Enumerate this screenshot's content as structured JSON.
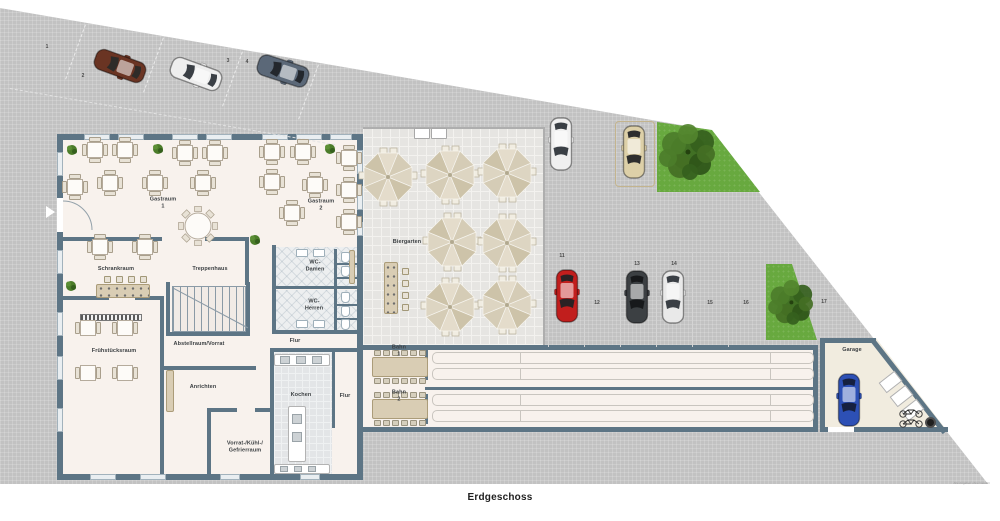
{
  "title": {
    "text": "Erdgeschoss"
  },
  "watermark": {
    "text": "Alle Angaben ohne Gewähr"
  },
  "palette": {
    "wall": "#5d7585",
    "pavement": "#c2c2c2",
    "floor": "#f8f2ed",
    "biergarten_tile": "#e6e5e2",
    "grass": "#68a93f",
    "wood": "#d9cdb4"
  },
  "rooms": [
    {
      "id": "gastraum-1",
      "label": "Gastraum 1",
      "x": 163,
      "y": 203
    },
    {
      "id": "gastraum-2",
      "label": "Gastraum 2",
      "x": 321,
      "y": 205
    },
    {
      "id": "schrankraum",
      "label": "Schrankraum",
      "x": 116,
      "y": 269
    },
    {
      "id": "treppenhaus",
      "label": "Treppenhaus",
      "x": 210,
      "y": 269
    },
    {
      "id": "wc-damen",
      "label": "WC-Damen",
      "x": 315,
      "y": 266
    },
    {
      "id": "wc-herren",
      "label": "WC-Herren",
      "x": 314,
      "y": 305
    },
    {
      "id": "flur-1",
      "label": "Flur",
      "x": 295,
      "y": 341
    },
    {
      "id": "fruehstuecksraum",
      "label": "Frühstücksraum",
      "x": 114,
      "y": 351
    },
    {
      "id": "abstellraum-vorrat",
      "label": "Abstellraum/Vorrat",
      "x": 199,
      "y": 344
    },
    {
      "id": "anrichten",
      "label": "Anrichten",
      "x": 203,
      "y": 387
    },
    {
      "id": "kochen",
      "label": "Kochen",
      "x": 301,
      "y": 395
    },
    {
      "id": "flur-2",
      "label": "Flur",
      "x": 345,
      "y": 396
    },
    {
      "id": "vorrat-kuehl-gefrierraum",
      "label": "Vorrat-/Kühl-/\nGefrierraum",
      "x": 245,
      "y": 447
    },
    {
      "id": "bahn-1",
      "label": "Bahn 1",
      "x": 399,
      "y": 351
    },
    {
      "id": "bahn-2",
      "label": "Bahn 2",
      "x": 399,
      "y": 396
    },
    {
      "id": "biergarten",
      "label": "Biergarten",
      "x": 407,
      "y": 242
    },
    {
      "id": "garage",
      "label": "Garage",
      "x": 852,
      "y": 350
    }
  ],
  "parking_numbers": [
    {
      "n": "1",
      "x": 47,
      "y": 47
    },
    {
      "n": "2",
      "x": 83,
      "y": 76
    },
    {
      "n": "3",
      "x": 228,
      "y": 61
    },
    {
      "n": "4",
      "x": 247,
      "y": 62
    },
    {
      "n": "11",
      "x": 562,
      "y": 256
    },
    {
      "n": "12",
      "x": 597,
      "y": 303
    },
    {
      "n": "13",
      "x": 637,
      "y": 264
    },
    {
      "n": "14",
      "x": 674,
      "y": 264
    },
    {
      "n": "15",
      "x": 710,
      "y": 303
    },
    {
      "n": "16",
      "x": 746,
      "y": 303
    },
    {
      "n": "17",
      "x": 824,
      "y": 302
    }
  ],
  "cars": [
    {
      "id": "car-space-2-brown",
      "color": "#6a3423",
      "glass": "#2e2b28",
      "x": 120,
      "y": 66,
      "rot": 110
    },
    {
      "id": "car-space-3-white",
      "color": "#eeeeee",
      "glass": "#3a3f45",
      "x": 196,
      "y": 74,
      "rot": 110
    },
    {
      "id": "car-space-4-gray",
      "color": "#5b6878",
      "glass": "#23272d",
      "x": 283,
      "y": 71,
      "rot": 108
    },
    {
      "id": "car-top-white",
      "color": "#f0f0f0",
      "glass": "#3a3f45",
      "x": 561,
      "y": 144,
      "rot": 0
    },
    {
      "id": "van-top-beige",
      "color": "#ddd0a8",
      "glass": "#2e2e2e",
      "x": 634,
      "y": 152,
      "rot": 0
    },
    {
      "id": "car-space-11-red",
      "color": "#c11e1d",
      "glass": "#2a2224",
      "x": 567,
      "y": 296,
      "rot": 0
    },
    {
      "id": "car-space-13-dark",
      "color": "#3c4043",
      "glass": "#17191b",
      "x": 637,
      "y": 297,
      "rot": 0
    },
    {
      "id": "car-space-14-white",
      "color": "#e9e9e9",
      "glass": "#3a3f45",
      "x": 673,
      "y": 297,
      "rot": 0
    },
    {
      "id": "car-garage-blue",
      "color": "#2d50b5",
      "glass": "#16203f",
      "x": 849,
      "y": 400,
      "rot": 0
    }
  ],
  "umbrellas": [
    {
      "x": 388,
      "y": 177
    },
    {
      "x": 450,
      "y": 175
    },
    {
      "x": 507,
      "y": 173
    },
    {
      "x": 452,
      "y": 242
    },
    {
      "x": 507,
      "y": 243
    },
    {
      "x": 450,
      "y": 307
    },
    {
      "x": 507,
      "y": 305
    }
  ],
  "tables_4seat": [
    {
      "x": 95,
      "y": 150
    },
    {
      "x": 125,
      "y": 150
    },
    {
      "x": 185,
      "y": 153
    },
    {
      "x": 215,
      "y": 153
    },
    {
      "x": 272,
      "y": 152
    },
    {
      "x": 303,
      "y": 152
    },
    {
      "x": 75,
      "y": 187
    },
    {
      "x": 110,
      "y": 183
    },
    {
      "x": 155,
      "y": 183
    },
    {
      "x": 203,
      "y": 183
    },
    {
      "x": 272,
      "y": 182
    },
    {
      "x": 315,
      "y": 185
    },
    {
      "x": 349,
      "y": 158
    },
    {
      "x": 349,
      "y": 190
    },
    {
      "x": 349,
      "y": 222
    },
    {
      "x": 292,
      "y": 213
    },
    {
      "x": 100,
      "y": 247
    },
    {
      "x": 145,
      "y": 247
    }
  ],
  "tables_2seat": [
    {
      "x": 88,
      "y": 328
    },
    {
      "x": 125,
      "y": 328
    },
    {
      "x": 88,
      "y": 373
    },
    {
      "x": 125,
      "y": 373
    }
  ],
  "round_table": {
    "x": 198,
    "y": 226
  },
  "trees": [
    {
      "id": "tree-top",
      "x": 688,
      "y": 152,
      "s": 1.0
    },
    {
      "id": "bush-right",
      "x": 791,
      "y": 302,
      "s": 0.8
    }
  ],
  "plants": [
    {
      "x": 72,
      "y": 150
    },
    {
      "x": 158,
      "y": 149
    },
    {
      "x": 330,
      "y": 149
    },
    {
      "x": 71,
      "y": 286
    },
    {
      "x": 255,
      "y": 240
    }
  ],
  "stools_bar": [
    {
      "x": 104,
      "y": 276
    },
    {
      "x": 116,
      "y": 276
    },
    {
      "x": 128,
      "y": 276
    },
    {
      "x": 140,
      "y": 276
    }
  ],
  "stools_biergarten": [
    {
      "x": 402,
      "y": 268
    },
    {
      "x": 402,
      "y": 280
    },
    {
      "x": 402,
      "y": 292
    },
    {
      "x": 402,
      "y": 304
    }
  ]
}
